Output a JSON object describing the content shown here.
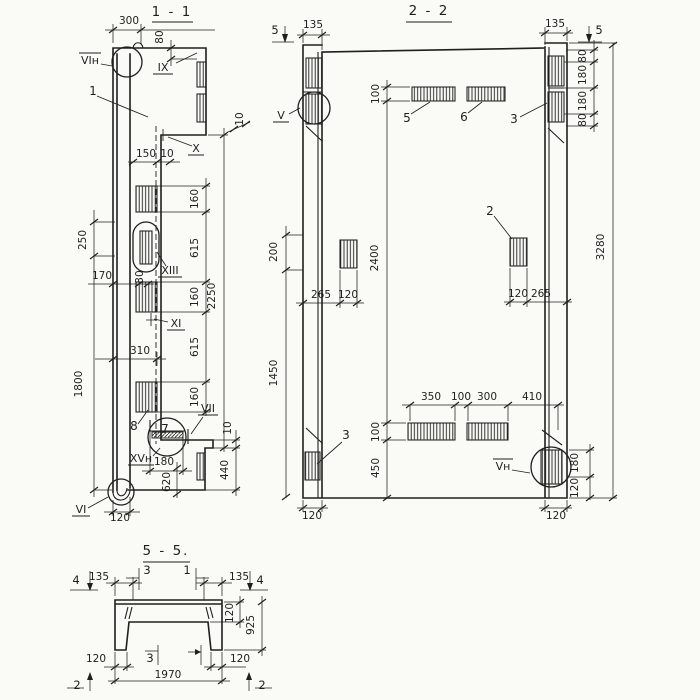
{
  "colors": {
    "ink": "#1f1f1d",
    "paper": "#fafaf7"
  },
  "view11": {
    "title": "1 - 1",
    "dims": {
      "w300": "300",
      "h80": "80",
      "w150": "150",
      "t10": "10",
      "h160": "160",
      "h615": "615",
      "h2250": "2250",
      "h250": "250",
      "w170": "170",
      "w30": "30",
      "h1800": "1800",
      "w310": "310",
      "w180": "180",
      "h620": "620",
      "h440": "440",
      "w120": "120"
    },
    "refs": {
      "vin": "VIн",
      "ix": "IX",
      "x": "X",
      "xiii": "XIII",
      "xi": "XI",
      "vii": "VII",
      "xvn": "XVн",
      "vi": "VI"
    },
    "parts": {
      "p1": "1",
      "p7": "7",
      "p8": "8"
    }
  },
  "view22": {
    "title": "2 - 2",
    "dims": {
      "w135": "135",
      "h80": "80",
      "h180": "180",
      "h100": "100",
      "h200": "200",
      "h1450": "1450",
      "h2400": "2400",
      "h3280": "3280",
      "w265": "265",
      "w120": "120",
      "w350": "350",
      "w100": "100",
      "w300": "300",
      "w410": "410",
      "h450": "450"
    },
    "refs": {
      "v": "V",
      "vn": "Vн"
    },
    "parts": {
      "p2": "2",
      "p3": "3",
      "p5": "5",
      "p6": "6"
    },
    "markers": {
      "m5": "5"
    }
  },
  "view55": {
    "title": "5 - 5.",
    "dims": {
      "w135": "135",
      "t120": "120",
      "h925": "925",
      "w1970": "1970"
    },
    "markers": {
      "m4": "4",
      "m3": "3",
      "m1": "1",
      "m2": "2"
    }
  }
}
